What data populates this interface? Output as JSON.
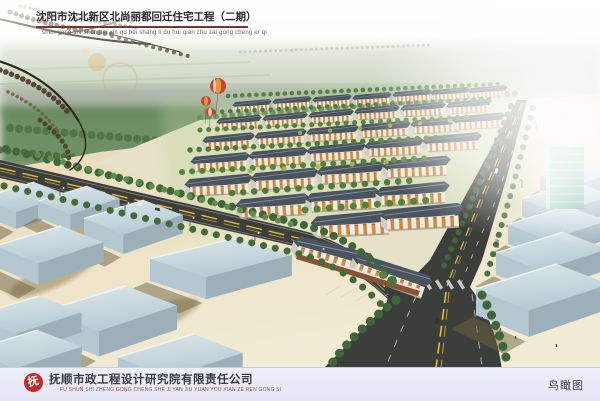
{
  "header": {
    "title": "沈阳市沈北新区北尚丽都回迁住宅工程（二期）",
    "title_pinyin": "shen yang shi shen bei xin qu bei shang li du hui qian zhu zai gong cheng er qi"
  },
  "footer": {
    "company_name": "抚顺市政工程设计研究院有限责任公司",
    "company_pinyin": "FU SHUN SHI ZHENG GONG CHENG SHE JI YAN JIU YUAN YOU XIAN ZE REN GONG SI",
    "logo_glyph": "抚",
    "view_label": "鸟瞰图"
  },
  "colors": {
    "title_underline": "#7b3434",
    "footer_background": "#edeef9",
    "logo_red": "#bf2c28",
    "company_pinyin_red": "#a35050",
    "road": "#3c3e3b",
    "lane_yellow": "#e2bd39",
    "roof": "#4a545f",
    "facade_accent": "#d08a3e",
    "warehouse_blue": "#c2d3da",
    "ground_beige": "#ecdfbe",
    "tree_green": "#4f7c3c",
    "balloon_red": "#c64534",
    "glass_tower_teal": "#8fc4b2"
  }
}
